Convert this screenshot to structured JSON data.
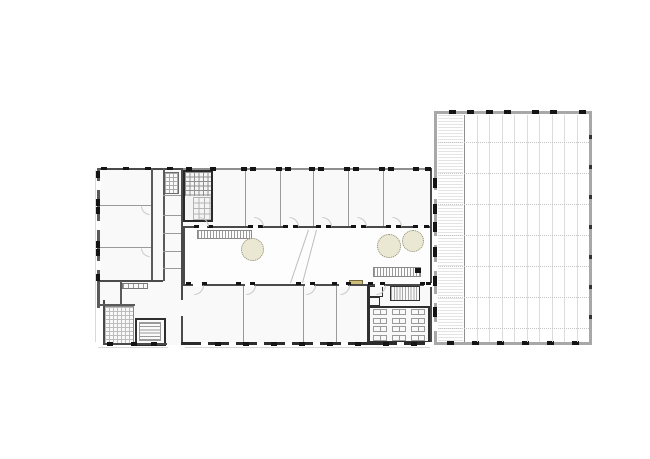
{
  "meta": {
    "kind": "architectural-ground-floor-plan",
    "canvas": {
      "w": 650,
      "h": 459
    }
  },
  "palette": {
    "wall": "#4a4a4a",
    "wallDark": "#141414",
    "band": "#8f8f8f",
    "partition": "#9a9a9a",
    "innerWall": "#5a5a5a",
    "facade": "#d9d9d9",
    "floor": "#f9f9f9",
    "courtFloor": "#fdfdfd",
    "hallBorder": "#a8a8a8",
    "grid": "#dcdcdc",
    "beamDotted": "#c6c6c6",
    "arc": "#c9c9c9",
    "treeFill": "#eae7d2",
    "treeEdge": "#8b8b79",
    "planterFill": "#cdbc7a",
    "planterEdge": "#776a3e",
    "white": "#ffffff"
  },
  "plan": {
    "rects": [
      {
        "n": "left-wing-floor",
        "x": 97,
        "y": 168,
        "w": 84,
        "h": 139,
        "fill": "#f9f9f9"
      },
      {
        "n": "left-wing-lower-floor",
        "x": 103,
        "y": 300,
        "w": 78,
        "h": 45,
        "fill": "#f9f9f9"
      },
      {
        "n": "top-wing-floor",
        "x": 181,
        "y": 168,
        "w": 251,
        "h": 60,
        "fill": "#f9f9f9"
      },
      {
        "n": "courtyard-floor",
        "x": 183,
        "y": 228,
        "w": 248,
        "h": 57,
        "fill": "#fdfdfd"
      },
      {
        "n": "bottom-wing-floor",
        "x": 181,
        "y": 285,
        "w": 251,
        "h": 60,
        "fill": "#f9f9f9"
      },
      {
        "n": "hall-floor",
        "x": 434,
        "y": 111,
        "w": 158,
        "h": 234,
        "fill": "#ffffff",
        "stroke": "#a8a8a8",
        "sw": 3
      },
      {
        "n": "hall-walkway",
        "x": 438,
        "y": 115,
        "w": 25,
        "h": 226,
        "hatch": {
          "dir": "h",
          "period": 3,
          "color": "#e4e4e4"
        }
      },
      {
        "n": "stair-core",
        "x": 183,
        "y": 170,
        "w": 30,
        "h": 52,
        "fill": "#f4f4f4",
        "stroke": "#2a2a2a",
        "sw": 2
      },
      {
        "n": "wc-cells-hatch",
        "x": 185,
        "y": 172,
        "w": 26,
        "h": 24,
        "hatch": {
          "dir": "grid",
          "period": 4.5,
          "color": "#8f8f8f"
        }
      },
      {
        "n": "stair-tiles-hatch",
        "x": 193,
        "y": 197,
        "w": 18,
        "h": 23,
        "hatch": {
          "dir": "grid",
          "period": 5.5,
          "color": "#b3b3b3"
        }
      },
      {
        "n": "wc-room-left-wing",
        "x": 164,
        "y": 172,
        "w": 15,
        "h": 22,
        "stroke": "#6a6a6a",
        "sw": 1,
        "hatch": {
          "dir": "grid",
          "period": 4,
          "color": "#aaaaaa"
        }
      },
      {
        "n": "terrace-hatch",
        "x": 104,
        "y": 306,
        "w": 30,
        "h": 38,
        "stroke": "#8a8a8a",
        "sw": 1,
        "hatch": {
          "dir": "grid",
          "period": 4,
          "color": "#bcbcbc"
        }
      },
      {
        "n": "stair-room",
        "x": 135,
        "y": 318,
        "w": 31,
        "h": 28,
        "fill": "#fbfbfb",
        "stroke": "#2f2f2f",
        "sw": 2
      },
      {
        "n": "stair-treads",
        "x": 139,
        "y": 322,
        "w": 22,
        "h": 19,
        "stroke": "#9a9a9a",
        "sw": 1,
        "hatch": {
          "dir": "h",
          "period": 3.2,
          "color": "#9a9a9a"
        }
      },
      {
        "n": "courtyard-stair-north",
        "x": 197,
        "y": 230,
        "w": 55,
        "h": 9,
        "stroke": "#8a8a8a",
        "sw": 1,
        "hatch": {
          "dir": "v",
          "period": 3,
          "color": "#9a9a9a"
        }
      },
      {
        "n": "courtyard-stair-south",
        "x": 373,
        "y": 267,
        "w": 48,
        "h": 10,
        "stroke": "#8a8a8a",
        "sw": 1,
        "hatch": {
          "dir": "v",
          "period": 3,
          "color": "#9a9a9a"
        }
      },
      {
        "n": "planter",
        "x": 349,
        "y": 280,
        "w": 14,
        "h": 6,
        "fill": "#cdbc7a",
        "stroke": "#776a3e",
        "sw": 1
      },
      {
        "n": "small-room-a",
        "x": 369,
        "y": 286,
        "w": 14,
        "h": 11,
        "stroke": "#2f2f2f",
        "sw": 1.5
      },
      {
        "n": "small-room-b",
        "x": 369,
        "y": 297,
        "w": 11,
        "h": 9,
        "stroke": "#2f2f2f",
        "sw": 1.5
      },
      {
        "n": "stair-south-east",
        "x": 390,
        "y": 286,
        "w": 30,
        "h": 15,
        "stroke": "#2f2f2f",
        "sw": 1.5,
        "hatch": {
          "dir": "v",
          "period": 2.8,
          "color": "#a8a8a8"
        }
      },
      {
        "n": "desk-room",
        "x": 368,
        "y": 306,
        "w": 62,
        "h": 37,
        "stroke": "#2f2f2f",
        "sw": 2
      },
      {
        "n": "kitchen-fixtures",
        "x": 122,
        "y": 283,
        "w": 26,
        "h": 6,
        "stroke": "#777777",
        "sw": 1,
        "hatch": {
          "dir": "v",
          "period": 5,
          "color": "#999999"
        }
      }
    ],
    "lines": [
      {
        "n": "top-wing-north-wall",
        "o": "h",
        "x": 181,
        "y": 168,
        "len": 251,
        "w": 2,
        "color": "#8f8f8f"
      },
      {
        "n": "top-wing-south-wall",
        "o": "h",
        "x": 181,
        "y": 226,
        "len": 251,
        "w": 2,
        "color": "#4a4a4a"
      },
      {
        "n": "wing-west-wall",
        "o": "v",
        "x": 181,
        "y": 168,
        "len": 177,
        "w": 2,
        "color": "#4a4a4a"
      },
      {
        "n": "wing-east-wall",
        "o": "v",
        "x": 429.5,
        "y": 168,
        "len": 177,
        "w": 2.5,
        "color": "#4a4a4a"
      },
      {
        "n": "courtyard-west-wall",
        "o": "v",
        "x": 183,
        "y": 228,
        "len": 57,
        "w": 1.5,
        "color": "#4a4a4a"
      },
      {
        "n": "bottom-wing-north-wall",
        "o": "h",
        "x": 181,
        "y": 283.5,
        "len": 251,
        "w": 2,
        "color": "#4a4a4a"
      },
      {
        "n": "bottom-wing-south-wall",
        "o": "h",
        "x": 181,
        "y": 342,
        "len": 251,
        "w": 3,
        "color": "#2b2b2b"
      },
      {
        "n": "south-sill-line",
        "o": "h",
        "x": 185,
        "y": 347,
        "len": 245,
        "w": 1,
        "color": "#d6d6d6"
      },
      {
        "n": "partition",
        "o": "v",
        "x": 245,
        "y": 170,
        "len": 56,
        "w": 1.3,
        "color": "#9a9a9a"
      },
      {
        "n": "partition",
        "o": "v",
        "x": 280,
        "y": 170,
        "len": 56,
        "w": 1.3,
        "color": "#9a9a9a"
      },
      {
        "n": "partition",
        "o": "v",
        "x": 313,
        "y": 170,
        "len": 56,
        "w": 1.3,
        "color": "#9a9a9a"
      },
      {
        "n": "partition",
        "o": "v",
        "x": 348,
        "y": 170,
        "len": 56,
        "w": 1.3,
        "color": "#9a9a9a"
      },
      {
        "n": "partition",
        "o": "v",
        "x": 383,
        "y": 170,
        "len": 56,
        "w": 1.3,
        "color": "#9a9a9a"
      },
      {
        "n": "partition",
        "o": "v",
        "x": 243,
        "y": 285.5,
        "len": 56.5,
        "w": 1.3,
        "color": "#9a9a9a"
      },
      {
        "n": "partition",
        "o": "v",
        "x": 303,
        "y": 285.5,
        "len": 56.5,
        "w": 1.3,
        "color": "#9a9a9a"
      },
      {
        "n": "partition",
        "o": "v",
        "x": 336,
        "y": 285.5,
        "len": 56.5,
        "w": 1.3,
        "color": "#9a9a9a"
      },
      {
        "n": "bottom-wing-thick-wall",
        "o": "v",
        "x": 366.5,
        "y": 285,
        "len": 58,
        "w": 2.5,
        "color": "#2f2f2f"
      },
      {
        "n": "left-wing-north-wall",
        "o": "h",
        "x": 97,
        "y": 168,
        "len": 84,
        "w": 2,
        "color": "#4a4a4a"
      },
      {
        "n": "left-wing-west-wall",
        "o": "v",
        "x": 97,
        "y": 168,
        "len": 140,
        "w": 2.5,
        "color": "#5a5a5a"
      },
      {
        "n": "left-wing-west-wall-lower",
        "o": "v",
        "x": 103,
        "y": 300,
        "len": 45,
        "w": 2,
        "color": "#4a4a4a"
      },
      {
        "n": "left-wing-south-wall",
        "o": "h",
        "x": 103,
        "y": 343,
        "len": 64,
        "w": 2,
        "color": "#4a4a4a"
      },
      {
        "n": "corridor-wall-west",
        "o": "v",
        "x": 151,
        "y": 168,
        "len": 113,
        "w": 1.5,
        "color": "#5a5a5a"
      },
      {
        "n": "corridor-wall-east",
        "o": "v",
        "x": 163,
        "y": 168,
        "len": 113,
        "w": 1.5,
        "color": "#5a5a5a"
      },
      {
        "n": "partition",
        "o": "h",
        "x": 98,
        "y": 205,
        "len": 53,
        "w": 1.3,
        "color": "#9a9a9a"
      },
      {
        "n": "partition",
        "o": "h",
        "x": 98,
        "y": 247,
        "len": 53,
        "w": 1.3,
        "color": "#9a9a9a"
      },
      {
        "n": "left-wing-mid-wall",
        "o": "h",
        "x": 98,
        "y": 280,
        "len": 65,
        "w": 2,
        "color": "#4a4a4a"
      },
      {
        "n": "kitchen-wall",
        "o": "v",
        "x": 120,
        "y": 281,
        "len": 24,
        "w": 1.5,
        "color": "#5a5a5a"
      },
      {
        "n": "kitchen-south-wall",
        "o": "h",
        "x": 98,
        "y": 304,
        "len": 37,
        "w": 1.5,
        "color": "#5a5a5a"
      },
      {
        "n": "partition",
        "o": "h",
        "x": 163,
        "y": 195,
        "len": 18,
        "w": 1.2,
        "color": "#9a9a9a"
      },
      {
        "n": "partition",
        "o": "h",
        "x": 163,
        "y": 215,
        "len": 18,
        "w": 1.2,
        "color": "#9a9a9a"
      },
      {
        "n": "partition",
        "o": "h",
        "x": 163,
        "y": 233,
        "len": 18,
        "w": 1.2,
        "color": "#9a9a9a"
      },
      {
        "n": "partition",
        "o": "h",
        "x": 163,
        "y": 251,
        "len": 18,
        "w": 1.2,
        "color": "#9a9a9a"
      },
      {
        "n": "partition",
        "o": "h",
        "x": 163,
        "y": 268,
        "len": 18,
        "w": 1.2,
        "color": "#9a9a9a"
      },
      {
        "n": "facade-line",
        "o": "v",
        "x": 95,
        "y": 170,
        "len": 172,
        "w": 1,
        "color": "#d9d9d9"
      },
      {
        "n": "facade-line",
        "o": "h",
        "x": 98,
        "y": 347,
        "len": 70,
        "w": 1,
        "color": "#d9d9d9"
      }
    ],
    "dlines": [
      {
        "n": "courtyard-ramp-edge",
        "x1": 309,
        "y1": 230,
        "x2": 291,
        "y2": 283,
        "w": 1,
        "color": "#bdbdbd"
      },
      {
        "n": "courtyard-ramp-edge",
        "x1": 317,
        "y1": 230,
        "x2": 303,
        "y2": 283,
        "w": 1,
        "color": "#bdbdbd"
      }
    ],
    "gaps": [
      {
        "n": "door-opening",
        "o": "h",
        "y": 225.5,
        "h": 4,
        "w": 9,
        "fill": "#ffffff",
        "xs": [
          198,
          253,
          288,
          321,
          356,
          391,
          418
        ]
      },
      {
        "n": "door-opening",
        "o": "h",
        "y": 283,
        "h": 4,
        "w": 9,
        "fill": "#ffffff",
        "xs": [
          193,
          245,
          305,
          339,
          375,
          424
        ]
      },
      {
        "n": "window-opening",
        "o": "h",
        "y": 341.5,
        "h": 5,
        "w": 7,
        "fill": "#ffffff",
        "xs": [
          201,
          229,
          257,
          285,
          313,
          341,
          397,
          425
        ]
      },
      {
        "n": "door-opening",
        "o": "v",
        "x": 433,
        "w": 5,
        "h": 9,
        "fill": "#ffffff",
        "ys": [
          190,
          236,
          262,
          294,
          322
        ]
      },
      {
        "n": "window-opening",
        "o": "v",
        "x": 95.5,
        "w": 5.5,
        "h": 9,
        "fill": "#ffffff",
        "ys": [
          181,
          221,
          261
        ]
      },
      {
        "n": "passage-opening",
        "o": "v",
        "x": 179.5,
        "w": 5,
        "h": 16,
        "fill": "#f9f9f9",
        "ys": [
          300
        ]
      }
    ],
    "ticks": [
      {
        "n": "column-mark",
        "o": "h",
        "y": 109.5,
        "h": 4,
        "w": 7,
        "color": "#141414",
        "xs": [
          449,
          467,
          486,
          504,
          532,
          550,
          579
        ]
      },
      {
        "n": "column-mark",
        "o": "h",
        "y": 341,
        "h": 4,
        "w": 7,
        "color": "#141414",
        "xs": [
          447,
          472,
          497,
          522,
          547,
          572
        ]
      },
      {
        "n": "wall-segment",
        "o": "v",
        "x": 432.5,
        "w": 4,
        "h": 10,
        "color": "#141414",
        "ys": [
          178,
          204,
          222,
          247,
          276,
          307
        ]
      },
      {
        "n": "column-mark",
        "o": "v",
        "x": 589,
        "w": 3,
        "h": 4,
        "color": "#333333",
        "ys": [
          135,
          165,
          195,
          225,
          255,
          285,
          315
        ]
      },
      {
        "n": "window-pier",
        "o": "h",
        "y": 167,
        "h": 3.5,
        "w": 6,
        "color": "#141414",
        "xs": [
          186,
          210,
          241,
          250,
          276,
          285,
          309,
          318,
          344,
          353,
          379,
          388,
          413,
          425
        ]
      },
      {
        "n": "door-jamb",
        "o": "h",
        "y": 224.5,
        "h": 3.5,
        "w": 5,
        "color": "#141414",
        "xs": [
          194,
          208,
          248,
          258,
          283,
          293,
          316,
          326,
          351,
          361,
          386,
          396,
          413,
          424
        ]
      },
      {
        "n": "door-jamb",
        "o": "h",
        "y": 281.5,
        "h": 3.5,
        "w": 5,
        "color": "#141414",
        "xs": [
          186,
          202,
          236,
          250,
          296,
          310,
          332,
          346,
          368,
          380,
          420,
          426
        ]
      },
      {
        "n": "window-pier",
        "o": "h",
        "y": 341.5,
        "h": 4.5,
        "w": 6,
        "color": "#141414",
        "xs": [
          215,
          243,
          271,
          299,
          327,
          355,
          383,
          411
        ]
      },
      {
        "n": "window-pier",
        "o": "v",
        "x": 95.5,
        "w": 4,
        "h": 7,
        "color": "#141414",
        "ys": [
          171,
          199,
          207,
          241,
          249,
          274
        ]
      },
      {
        "n": "window-pier",
        "o": "h",
        "y": 166.5,
        "h": 3.5,
        "w": 6,
        "color": "#141414",
        "xs": [
          101,
          123,
          145,
          167
        ]
      },
      {
        "n": "window-pier",
        "o": "h",
        "y": 342,
        "h": 4,
        "w": 6,
        "color": "#141414",
        "xs": [
          107,
          131,
          151
        ]
      },
      {
        "n": "corner-mark",
        "o": "h",
        "y": 268,
        "h": 5,
        "w": 6,
        "color": "#141414",
        "xs": [
          415
        ]
      }
    ],
    "arcs": [
      {
        "n": "door-swing",
        "x": 199,
        "y": 217,
        "r": 10,
        "corner": "tr"
      },
      {
        "n": "door-swing",
        "x": 254,
        "y": 217,
        "r": 10,
        "corner": "tr"
      },
      {
        "n": "door-swing",
        "x": 289,
        "y": 217,
        "r": 10,
        "corner": "tr"
      },
      {
        "n": "door-swing",
        "x": 322,
        "y": 217,
        "r": 10,
        "corner": "tr"
      },
      {
        "n": "door-swing",
        "x": 357,
        "y": 217,
        "r": 10,
        "corner": "tr"
      },
      {
        "n": "door-swing",
        "x": 392,
        "y": 217,
        "r": 10,
        "corner": "tr"
      },
      {
        "n": "door-swing",
        "x": 194,
        "y": 285,
        "r": 10,
        "corner": "br"
      },
      {
        "n": "door-swing",
        "x": 246,
        "y": 285,
        "r": 10,
        "corner": "br"
      },
      {
        "n": "door-swing",
        "x": 306,
        "y": 285,
        "r": 10,
        "corner": "br"
      },
      {
        "n": "door-swing",
        "x": 340,
        "y": 285,
        "r": 10,
        "corner": "br"
      },
      {
        "n": "door-swing",
        "x": 376,
        "y": 285,
        "r": 10,
        "corner": "br"
      },
      {
        "n": "door-swing",
        "x": 141,
        "y": 206,
        "r": 9,
        "corner": "bl"
      },
      {
        "n": "door-swing",
        "x": 141,
        "y": 248,
        "r": 9,
        "corner": "bl"
      }
    ],
    "trees": [
      {
        "n": "tree-icon",
        "cx": 252,
        "cy": 249,
        "r": 11.5
      },
      {
        "n": "tree-icon",
        "cx": 389,
        "cy": 246,
        "r": 12
      },
      {
        "n": "tree-icon",
        "cx": 413,
        "cy": 241,
        "r": 11
      }
    ],
    "desks": {
      "cols": [
        373,
        392,
        411
      ],
      "rows": [
        309,
        317.5,
        326,
        334.5
      ],
      "w": 14,
      "h": 6,
      "stroke": "#9a9a9a"
    },
    "hall": {
      "strongLineX": 463.5,
      "strongLineColor": "#8f8f8f",
      "bayXs": [
        476.5,
        489,
        501.5,
        514,
        526.5,
        539,
        551.5,
        564,
        576.5
      ],
      "bayTop": 114.5,
      "bayBottom": 341.5,
      "bayColor": "#dcdcdc",
      "rowYs": [
        142,
        173,
        204,
        235,
        266,
        297,
        328
      ],
      "rowX": 437.5,
      "rowLen": 151,
      "rowColor": "#c6c6c6"
    }
  }
}
